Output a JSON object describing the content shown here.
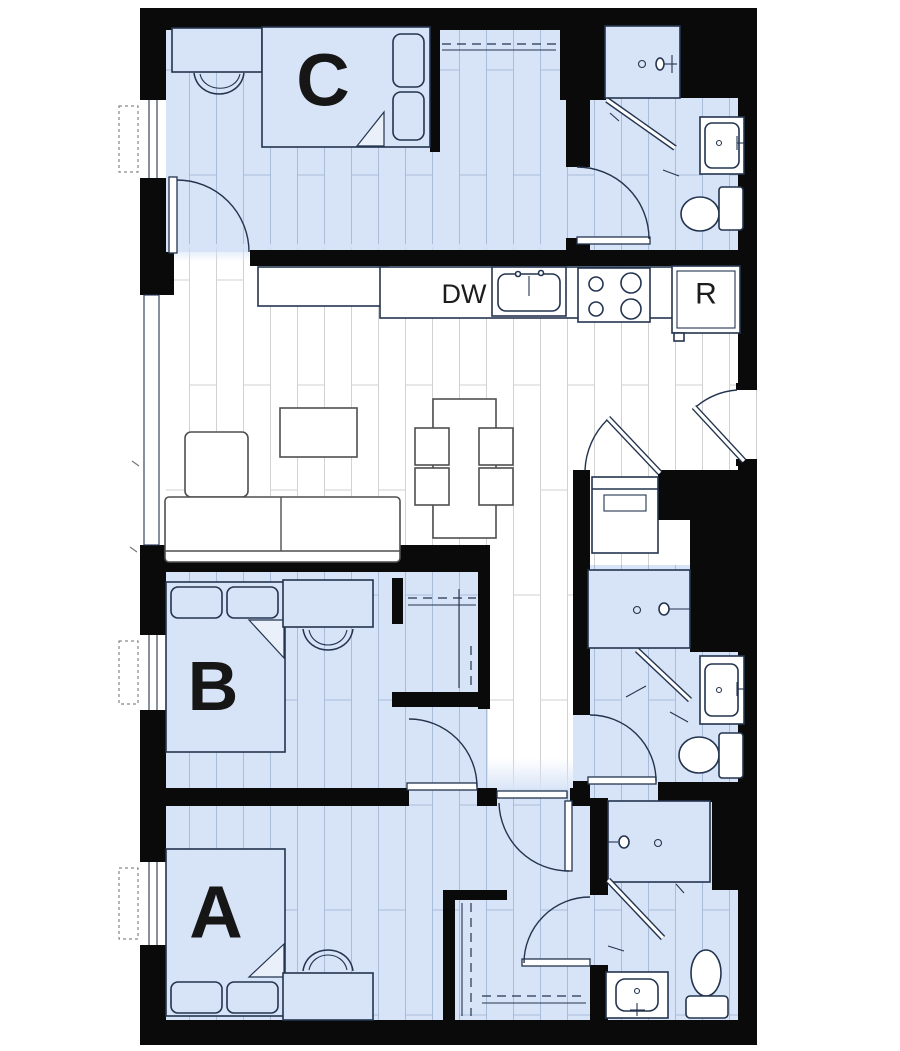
{
  "floor_plan": {
    "bedrooms": [
      {
        "id": "unit-a",
        "label": "A"
      },
      {
        "id": "unit-b",
        "label": "B"
      },
      {
        "id": "unit-c",
        "label": "C"
      }
    ],
    "kitchen": {
      "dishwasher": "DW",
      "refrigerator": "R"
    },
    "colors": {
      "wall": "#0a0a0a",
      "floor_blue": "#d7e3f6",
      "plank_blue_line": "#a9bcda",
      "floor_white": "#ffffff",
      "plank_white_line": "#d2d2d2",
      "line_dark": "#23344f",
      "furniture_line": "#4f4f4f",
      "label_color": "#161616",
      "fold_fill": "#e9f0fa"
    }
  }
}
